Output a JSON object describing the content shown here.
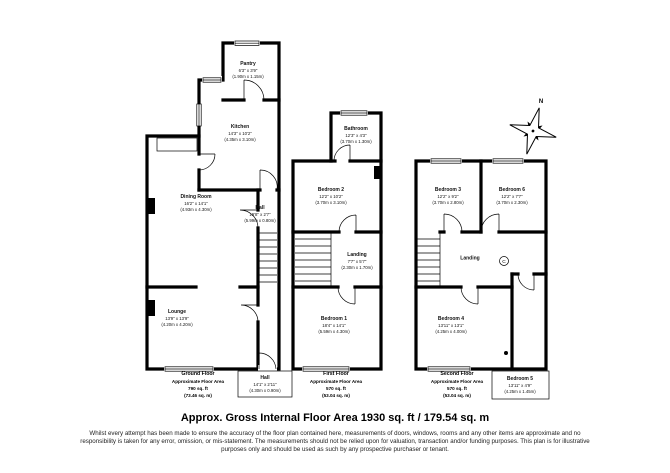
{
  "title": {
    "heading": "Approx. Gross Internal Floor Area 1930 sq. ft / 179.54 sq. m",
    "disclaimer": "Whilst every attempt has been made to ensure the accuracy of the floor plan contained here, measurements of doors, windows, rooms and any other items are approximate and no responsibility is taken for any error, omission, or mis-statement. The measurements should not be relied upon for valuation, transaction and/or funding purposes. This plan is for illustrative purposes only and should be used as such by any prospective purchaser or tenant."
  },
  "compass": {
    "north_label": "N"
  },
  "symbols": {
    "cupboard": "C"
  },
  "colors": {
    "wall": "#000000",
    "background": "#ffffff"
  },
  "floors": [
    {
      "name": "Ground Floor",
      "footer": {
        "line1": "Ground Floor",
        "line2": "Approximate Floor Area",
        "line3": "790 sq. ft",
        "line4": "(73.46 sq. m)"
      },
      "rooms": [
        {
          "name": "Pantry",
          "imperial": "6'3\" x 3'9\"",
          "metric": "(1.90m x 1.15m)"
        },
        {
          "name": "Kitchen",
          "imperial": "14'3\" x 10'2\"",
          "metric": "(4.35m x 3.10m)"
        },
        {
          "name": "Dining Room",
          "imperial": "16'2\" x 14'1\"",
          "metric": "(4.93m x 4.30m)"
        },
        {
          "name": "Hall",
          "imperial": "19'8\" x 2'7\"",
          "metric": "(5.99m x 0.80m)"
        },
        {
          "name": "Lounge",
          "imperial": "13'9\" x 13'9\"",
          "metric": "(4.20m x 4.20m)"
        },
        {
          "name": "Hall",
          "imperial": "14'1\" x 2'11\"",
          "metric": "(4.30m x 0.90m)"
        }
      ]
    },
    {
      "name": "First Floor",
      "footer": {
        "line1": "First Floor",
        "line2": "Approximate Floor Area",
        "line3": "570 sq. ft",
        "line4": "(53.04 sq. m)"
      },
      "rooms": [
        {
          "name": "Bathroom",
          "imperial": "12'3\" x 4'3\"",
          "metric": "(3.70m x 1.30m)"
        },
        {
          "name": "Bedroom 2",
          "imperial": "12'2\" x 10'2\"",
          "metric": "(3.70m x 3.10m)"
        },
        {
          "name": "Landing",
          "imperial": "7'7\" x 5'7\"",
          "metric": "(2.30m x 1.70m)"
        },
        {
          "name": "Bedroom 1",
          "imperial": "18'4\" x 14'1\"",
          "metric": "(5.59m x 4.30m)"
        }
      ]
    },
    {
      "name": "Second Floor",
      "footer": {
        "line1": "Second Floor",
        "line2": "Approximate Floor Area",
        "line3": "570 sq. ft",
        "line4": "(53.04 sq. m)"
      },
      "rooms": [
        {
          "name": "Bedroom 3",
          "imperial": "12'2\" x 9'2\"",
          "metric": "(3.70m x 2.80m)"
        },
        {
          "name": "Bedroom 6",
          "imperial": "12'2\" x 7'7\"",
          "metric": "(3.70m x 2.30m)"
        },
        {
          "name": "Landing",
          "imperial": "",
          "metric": ""
        },
        {
          "name": "Bedroom 4",
          "imperial": "13'11\" x 13'1\"",
          "metric": "(4.25m x 4.00m)"
        },
        {
          "name": "Bedroom 5",
          "imperial": "13'11\" x 4'9\"",
          "metric": "(4.25m x 1.45m)"
        }
      ]
    }
  ]
}
